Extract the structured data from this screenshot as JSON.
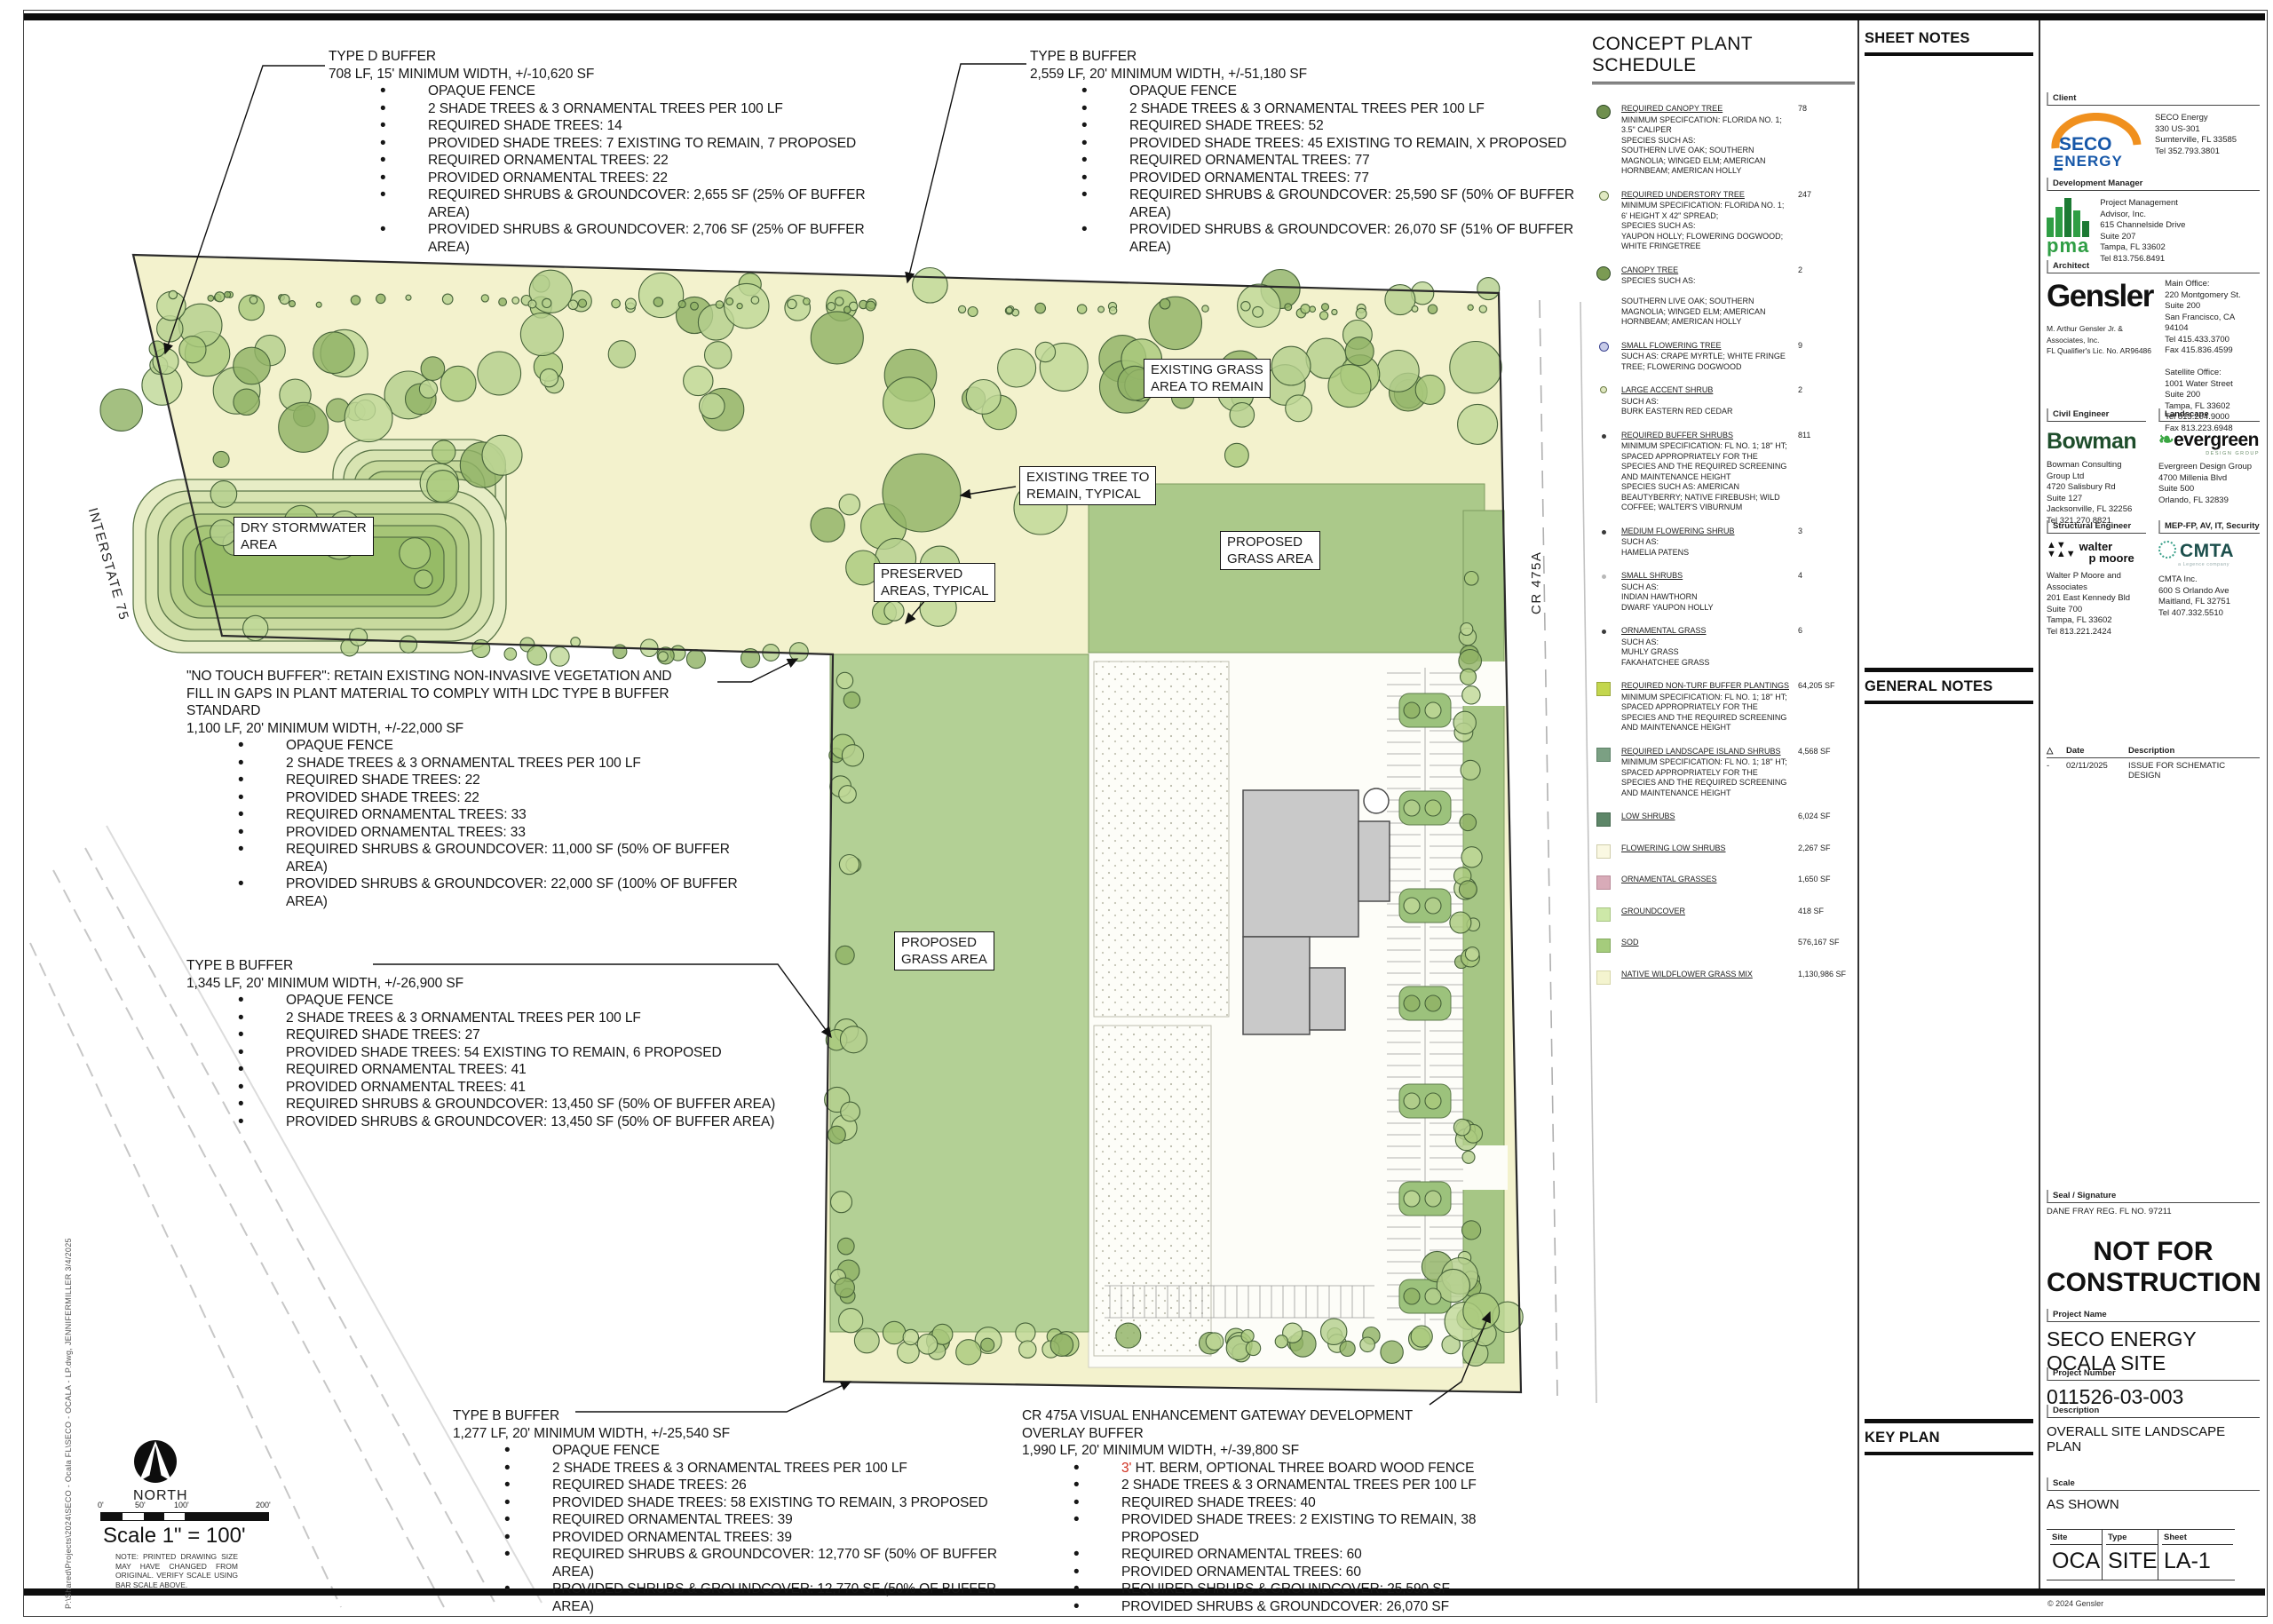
{
  "sheet": {
    "copyright": "© 2024 Gensler",
    "file_path_note": "P:\\Shared\\Projects\\2024\\SECO  -  Ocala FL\\SECO  -  OCALA  -  LP.dwg,  JENNIFERMILLER  3/4/2025"
  },
  "panels": {
    "sheet_notes": "SHEET NOTES",
    "general_notes": "GENERAL NOTES",
    "key_plan": "KEY PLAN"
  },
  "plan": {
    "labels": {
      "dry_stormwater": "DRY STORMWATER\nAREA",
      "existing_grass": "EXISTING GRASS\nAREA TO REMAIN",
      "existing_tree": "EXISTING TREE TO\nREMAIN, TYPICAL",
      "preserved": "PRESERVED\nAREAS, TYPICAL",
      "proposed_grass_right": "PROPOSED\nGRASS AREA",
      "proposed_grass_left": "PROPOSED\nGRASS AREA"
    },
    "road_labels": {
      "interstate": "INTERSTATE 75",
      "cr475a": "CR 475A"
    },
    "north_label": "NORTH",
    "scale_text": "Scale 1\" = 100'",
    "scale_ticks": [
      "0'",
      "50'",
      "100'",
      "200'"
    ],
    "scale_note": "NOTE:  PRINTED DRAWING SIZE MAY HAVE CHANGED FROM ORIGINAL.  VERIFY SCALE USING BAR SCALE ABOVE.",
    "buffer_blocks": [
      {
        "title": "TYPE D BUFFER",
        "sub": "708 LF, 15' MINIMUM WIDTH, +/-10,620 SF",
        "bullets": [
          {
            "r": "",
            "t": "OPAQUE FENCE"
          },
          {
            "r": "",
            "t": "2 SHADE TREES & 3 ORNAMENTAL TREES PER 100 LF"
          },
          {
            "r": "",
            "t": "REQUIRED SHADE TREES: 14"
          },
          {
            "r": "",
            "t": "PROVIDED SHADE TREES: 7 EXISTING TO REMAIN, 7 PROPOSED"
          },
          {
            "r": "",
            "t": "REQUIRED ORNAMENTAL TREES: 22"
          },
          {
            "r": "",
            "t": "PROVIDED ORNAMENTAL TREES: 22"
          },
          {
            "r": "",
            "t": "REQUIRED SHRUBS & GROUNDCOVER: 2,655 SF (25% OF BUFFER AREA)"
          },
          {
            "r": "",
            "t": "PROVIDED SHRUBS & GROUNDCOVER: 2,706 SF (25% OF BUFFER AREA)"
          }
        ]
      },
      {
        "title": "TYPE B BUFFER",
        "sub": "2,559 LF, 20' MINIMUM WIDTH, +/-51,180 SF",
        "bullets": [
          {
            "r": "",
            "t": "OPAQUE FENCE"
          },
          {
            "r": "",
            "t": "2 SHADE TREES & 3 ORNAMENTAL TREES PER 100 LF"
          },
          {
            "r": "",
            "t": "REQUIRED SHADE TREES: 52"
          },
          {
            "r": "",
            "t": "PROVIDED SHADE TREES: 45 EXISTING TO REMAIN, X PROPOSED"
          },
          {
            "r": "",
            "t": "REQUIRED ORNAMENTAL TREES: 77"
          },
          {
            "r": "",
            "t": "PROVIDED ORNAMENTAL TREES: 77"
          },
          {
            "r": "",
            "t": "REQUIRED SHRUBS & GROUNDCOVER: 25,590 SF (50% OF BUFFER AREA)"
          },
          {
            "r": "",
            "t": "PROVIDED SHRUBS & GROUNDCOVER: 26,070 SF (51% OF BUFFER AREA)"
          }
        ]
      },
      {
        "title": "\"NO TOUCH BUFFER\": RETAIN EXISTING NON-INVASIVE VEGETATION AND\nFILL IN GAPS IN PLANT MATERIAL TO COMPLY WITH LDC TYPE B BUFFER\nSTANDARD",
        "sub": "1,100 LF, 20' MINIMUM WIDTH, +/-22,000 SF",
        "bullets": [
          {
            "r": "",
            "t": "OPAQUE FENCE"
          },
          {
            "r": "",
            "t": "2 SHADE TREES & 3 ORNAMENTAL TREES PER 100 LF"
          },
          {
            "r": "",
            "t": "REQUIRED SHADE TREES: 22"
          },
          {
            "r": "",
            "t": "PROVIDED SHADE TREES: 22"
          },
          {
            "r": "",
            "t": "REQUIRED ORNAMENTAL TREES: 33"
          },
          {
            "r": "",
            "t": "PROVIDED ORNAMENTAL TREES: 33"
          },
          {
            "r": "",
            "t": "REQUIRED SHRUBS & GROUNDCOVER: 11,000 SF (50% OF BUFFER\nAREA)"
          },
          {
            "r": "",
            "t": "PROVIDED SHRUBS & GROUNDCOVER: 22,000 SF (100% OF BUFFER\nAREA)"
          }
        ]
      },
      {
        "title": "TYPE B BUFFER",
        "sub": "1,345 LF, 20' MINIMUM WIDTH, +/-26,900 SF",
        "bullets": [
          {
            "r": "",
            "t": "OPAQUE FENCE"
          },
          {
            "r": "",
            "t": "2 SHADE TREES & 3 ORNAMENTAL TREES PER 100 LF"
          },
          {
            "r": "",
            "t": "REQUIRED SHADE TREES: 27"
          },
          {
            "r": "",
            "t": "PROVIDED SHADE TREES: 54 EXISTING TO REMAIN, 6 PROPOSED"
          },
          {
            "r": "",
            "t": "REQUIRED ORNAMENTAL TREES: 41"
          },
          {
            "r": "",
            "t": "PROVIDED ORNAMENTAL TREES: 41"
          },
          {
            "r": "",
            "t": "REQUIRED SHRUBS & GROUNDCOVER: 13,450 SF (50% OF BUFFER AREA)"
          },
          {
            "r": "",
            "t": "PROVIDED SHRUBS & GROUNDCOVER: 13,450 SF (50% OF BUFFER AREA)"
          }
        ]
      },
      {
        "title": "TYPE B BUFFER",
        "sub": "1,277 LF, 20' MINIMUM WIDTH, +/-25,540 SF",
        "bullets": [
          {
            "r": "",
            "t": "OPAQUE FENCE"
          },
          {
            "r": "",
            "t": "2 SHADE TREES & 3 ORNAMENTAL TREES PER 100 LF"
          },
          {
            "r": "",
            "t": "REQUIRED SHADE TREES: 26"
          },
          {
            "r": "",
            "t": "PROVIDED SHADE TREES: 58 EXISTING TO REMAIN, 3 PROPOSED"
          },
          {
            "r": "",
            "t": "REQUIRED ORNAMENTAL TREES: 39"
          },
          {
            "r": "",
            "t": "PROVIDED ORNAMENTAL TREES: 39"
          },
          {
            "r": "",
            "t": "REQUIRED SHRUBS & GROUNDCOVER: 12,770 SF (50% OF BUFFER AREA)"
          },
          {
            "r": "",
            "t": "PROVIDED SHRUBS & GROUNDCOVER: 12,770 SF (50% OF BUFFER AREA)"
          }
        ]
      },
      {
        "title": "CR 475A VISUAL ENHANCEMENT GATEWAY DEVELOPMENT\nOVERLAY BUFFER",
        "sub": "1,990 LF, 20' MINIMUM WIDTH, +/-39,800 SF",
        "bullets": [
          {
            "r": "3'",
            "t": " HT. BERM, OPTIONAL THREE BOARD WOOD FENCE"
          },
          {
            "r": "",
            "t": "2 SHADE TREES & 3 ORNAMENTAL TREES PER 100 LF"
          },
          {
            "r": "",
            "t": "REQUIRED SHADE TREES: 40"
          },
          {
            "r": "",
            "t": "PROVIDED SHADE TREES: 2 EXISTING TO REMAIN, 38 PROPOSED"
          },
          {
            "r": "",
            "t": "REQUIRED ORNAMENTAL TREES: 60"
          },
          {
            "r": "",
            "t": "PROVIDED ORNAMENTAL TREES: 60"
          },
          {
            "r": "",
            "t": "REQUIRED SHRUBS & GROUNDCOVER: 25,590 SF"
          },
          {
            "r": "",
            "t": "PROVIDED SHRUBS & GROUNDCOVER: 26,070 SF"
          }
        ]
      }
    ]
  },
  "plant_schedule": {
    "title": "CONCEPT PLANT SCHEDULE",
    "items": [
      {
        "name": "REQUIRED CANOPY TREE",
        "qty": "78",
        "sym": {
          "cls": "sy-lg",
          "color": "#6f8f4e",
          "border": "#2a4522"
        },
        "desc": "MINIMUM SPECIFCATION: FLORIDA NO. 1;\n3.5\" CALIPER\nSPECIES SUCH AS:\nSOUTHERN LIVE OAK; SOUTHERN\nMAGNOLIA; WINGED ELM; AMERICAN\nHORNBEAM; AMERICAN HOLLY"
      },
      {
        "name": "REQUIRED UNDERSTORY TREE",
        "qty": "247",
        "sym": {
          "cls": "sy-md",
          "color": "#e0e9c2",
          "border": "#5f7442"
        },
        "desc": "MINIMUM SPECIFICATION: FLORIDA NO. 1;\n6' HEIGHT X 42\" SPREAD;\nSPECIES SUCH AS:\nYAUPON HOLLY; FLOWERING DOGWOOD;\nWHITE FRINGETREE"
      },
      {
        "name": "CANOPY TREE",
        "qty": "2",
        "sym": {
          "cls": "sy-lg",
          "color": "#7b9b53",
          "border": "#2a4522"
        },
        "desc": "SPECIES SUCH AS:\n\nSOUTHERN LIVE OAK; SOUTHERN\nMAGNOLIA; WINGED ELM; AMERICAN\nHORNBEAM; AMERICAN HOLLY"
      },
      {
        "name": "SMALL FLOWERING TREE",
        "qty": "9",
        "sym": {
          "cls": "sy-md",
          "color": "#c7cbe8",
          "border": "#3c4490"
        },
        "desc": "SUCH AS: CRAPE MYRTLE; WHITE FRINGE\nTREE; FLOWERING DOGWOOD"
      },
      {
        "name": "LARGE ACCENT SHRUB",
        "qty": "2",
        "sym": {
          "cls": "sy-sm",
          "color": "#dfe7bf",
          "border": "#6a7a45"
        },
        "desc": "SUCH AS:\nBURK EASTERN RED CEDAR"
      },
      {
        "name": "REQUIRED BUFFER SHRUBS",
        "qty": "811",
        "sym": {
          "cls": "sy-dot",
          "color": "#3a3a3a",
          "border": "#3a3a3a"
        },
        "desc": "MINIMUM SPECIFICATION: FL NO. 1; 18\" HT;\nSPACED APPROPRIATELY FOR THE\nSPECIES AND THE REQUIRED SCREENING\nAND MAINTENANCE HEIGHT\nSPECIES SUCH AS: AMERICAN\nBEAUTYBERRY; NATIVE FIREBUSH; WILD\nCOFFEE; WALTER'S VIBURNUM"
      },
      {
        "name": "MEDIUM FLOWERING SHRUB",
        "qty": "3",
        "sym": {
          "cls": "sy-dot",
          "color": "#3a3a3a",
          "border": "#3a3a3a"
        },
        "desc": "SUCH AS:\nHAMELIA PATENS"
      },
      {
        "name": "SMALL SHRUBS",
        "qty": "4",
        "sym": {
          "cls": "sy-dot",
          "color": "#b8b8b8",
          "border": "#b8b8b8"
        },
        "desc": "SUCH AS:\nINDIAN HAWTHORN\nDWARF YAUPON HOLLY"
      },
      {
        "name": "ORNAMENTAL GRASS",
        "qty": "6",
        "sym": {
          "cls": "sy-dot",
          "color": "#3a3a3a",
          "border": "#3a3a3a"
        },
        "desc": "SUCH AS:\nMUHLY GRASS\nFAKAHATCHEE GRASS"
      },
      {
        "name": "REQUIRED NON-TURF BUFFER PLANTINGS",
        "qty": "64,205 SF",
        "sym": {
          "cls": "sy-sq",
          "color": "#c3d64e",
          "border": "#9aa83a"
        },
        "desc": "MINIMUM SPECIFICATION: FL NO. 1; 18\" HT;\nSPACED APPROPRIATELY FOR THE\nSPECIES AND THE REQUIRED SCREENING\nAND MAINTENANCE HEIGHT"
      },
      {
        "name": "REQUIRED LANDSCAPE ISLAND SHRUBS",
        "qty": "4,568 SF",
        "sym": {
          "cls": "sy-sq",
          "color": "#7ba083",
          "border": "#5d8168"
        },
        "desc": "MINIMUM SPECIFICATION: FL NO. 1; 18\" HT;\nSPACED APPROPRIATELY FOR THE\nSPECIES AND THE REQUIRED SCREENING\nAND MAINTENANCE HEIGHT"
      },
      {
        "name": "LOW SHRUBS",
        "qty": "6,024 SF",
        "sym": {
          "cls": "sy-sq",
          "color": "#5d8668",
          "border": "#46684f"
        },
        "desc": ""
      },
      {
        "name": "FLOWERING LOW SHRUBS",
        "qty": "2,267 SF",
        "sym": {
          "cls": "sy-sq",
          "color": "#faf8e2",
          "border": "#cfcdaa"
        },
        "desc": ""
      },
      {
        "name": "ORNAMENTAL GRASSES",
        "qty": "1,650 SF",
        "sym": {
          "cls": "sy-sq",
          "color": "#d8abb8",
          "border": "#b98a98"
        },
        "desc": ""
      },
      {
        "name": "GROUNDCOVER",
        "qty": "418 SF",
        "sym": {
          "cls": "sy-sq",
          "color": "#cde8a8",
          "border": "#a7c483"
        },
        "desc": ""
      },
      {
        "name": "SOD",
        "qty": "576,167 SF",
        "sym": {
          "cls": "sy-sq",
          "color": "#a5cc7c",
          "border": "#83a95e"
        },
        "desc": ""
      },
      {
        "name": "NATIVE WILDFLOWER GRASS MIX",
        "qty": "1,130,986 SF",
        "sym": {
          "cls": "sy-sq",
          "color": "#f4f4cf",
          "border": "#d5d5a8"
        },
        "desc": ""
      }
    ]
  },
  "titleblock": {
    "client": {
      "label": "Client",
      "logo_line1": "SECO",
      "logo_line2": "ENERGY",
      "addr": "SECO Energy\n330 US-301\nSumterville, FL 33585\nTel  352.793.3801"
    },
    "development_manager": {
      "label": "Development Manager",
      "logo_text": "pma",
      "addr": "Project Management\nAdvisor, Inc.\n615 Channelside Drive\nSuite 207\nTampa, FL 33602\nTel  813.756.8491"
    },
    "architect": {
      "label": "Architect",
      "logo_text": "Gensler",
      "sub": "M. Arthur Gensler Jr. & Associates, Inc.\nFL Qualifier's Lic. No. AR96486",
      "addr": "Main Office:\n220 Montgomery St.\nSuite 200\nSan Francisco, CA 94104\nTel  415.433.3700\nFax  415.836.4599\n\nSatellite Office:\n1001 Water Street\nSuite 200\nTampa, FL 33602\nTel  813.204.9000\nFax  813.223.6948"
    },
    "civil": {
      "label": "Civil Engineer",
      "logo_text": "Bowman",
      "addr": "Bowman Consulting\nGroup Ltd\n4720 Salisbury Rd\nSuite 127\nJacksonville, FL 32256\nTel  321.270.8821"
    },
    "landscape": {
      "label": "Landscape",
      "logo_text": "evergreen",
      "logo_tag": "DESIGN GROUP",
      "addr": "Evergreen Design Group\n4700 Millenia Blvd\nSuite 500\nOrlando, FL 32839"
    },
    "structural": {
      "label": "Structural Engineer",
      "logo_text": "walter\n   p moore",
      "addr": "Walter P Moore and\nAssociates\n201 East Kennedy Bld\nSuite 700\nTampa, FL 33602\nTel  813.221.2424"
    },
    "mep": {
      "label": "MEP-FP, AV, IT, Security",
      "logo_text": "CMTA",
      "logo_tag": "a Legence company",
      "addr": "CMTA Inc.\n600 S Orlando Ave\nMaitland, FL 32751\nTel  407.332.5510"
    },
    "revisions": {
      "symbol": "△",
      "date_header": "Date",
      "desc_header": "Description",
      "rows": [
        {
          "mark": "-",
          "date": "02/11/2025",
          "desc": "ISSUE FOR SCHEMATIC DESIGN"
        }
      ]
    },
    "seal": {
      "label": "Seal / Signature",
      "line": "DANE FRAY   REG. FL NO. 97211"
    },
    "stamp": "NOT FOR\nCONSTRUCTION",
    "project_name": {
      "label": "Project Name",
      "value": "SECO ENERGY\nOCALA SITE"
    },
    "project_number": {
      "label": "Project Number",
      "value": "011526-03-003"
    },
    "description": {
      "label": "Description",
      "value": "OVERALL SITE LANDSCAPE PLAN"
    },
    "scale": {
      "label": "Scale",
      "value": "AS SHOWN"
    },
    "sheet_table": {
      "site": {
        "label": "Site",
        "value": "OCA"
      },
      "type": {
        "label": "Type",
        "value": "SITE"
      },
      "sheet": {
        "label": "Sheet",
        "value": "LA-1"
      }
    }
  },
  "colors": {
    "buffer_yellow": "#f3f2cd",
    "sod_green": "#a5cc7c",
    "grass_green": "#b3d095",
    "accent_red": "#d03020",
    "non_turf": "#c3d64e"
  }
}
